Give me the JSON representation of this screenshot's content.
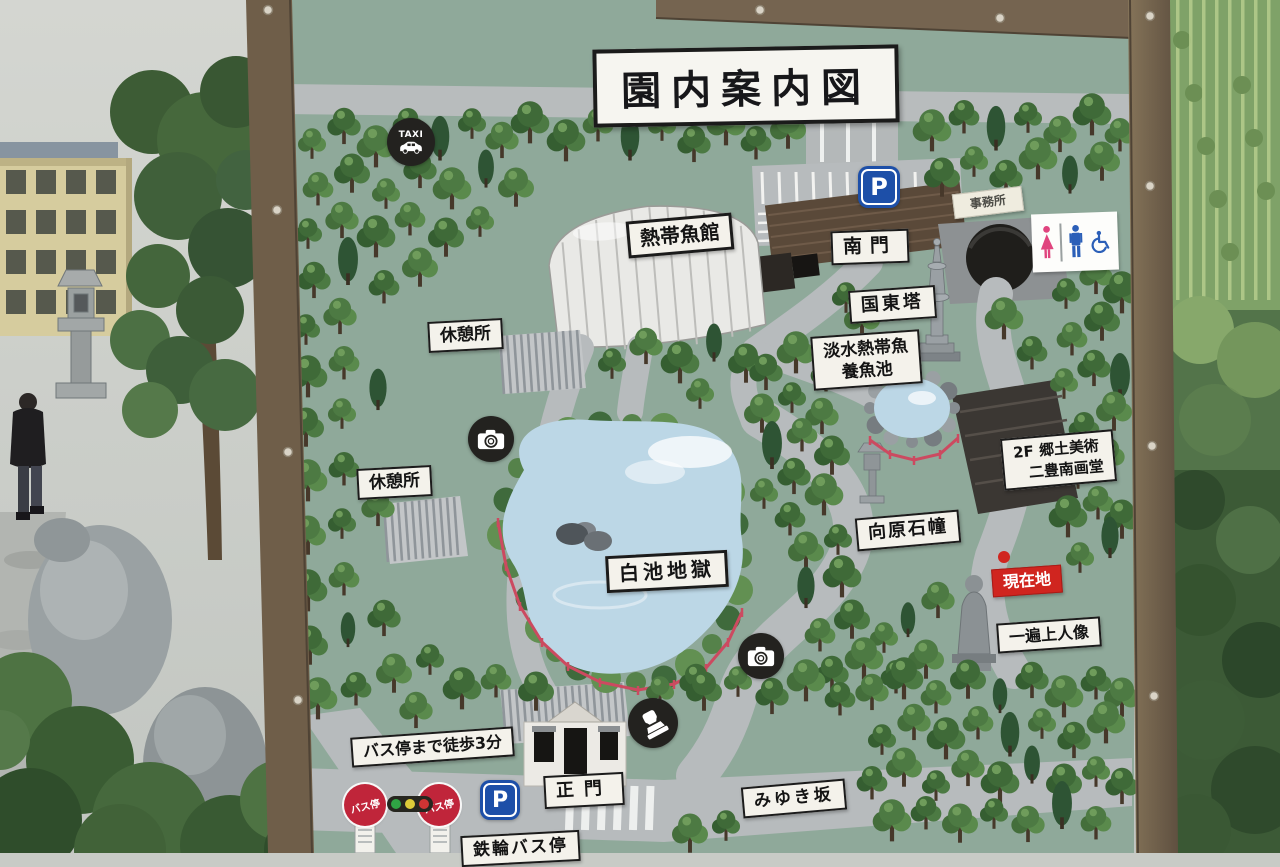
{
  "sign": {
    "title": "園内案内図",
    "labels": {
      "tropical_fish_hall": "熱帯魚館",
      "south_gate": "南門",
      "office": "事務所",
      "kunisaki_tower": "国東塔",
      "freshwater_line1": "淡水熱帯魚",
      "freshwater_line2": "養魚池",
      "rest_area": "休憩所",
      "shiraike_jigoku": "白池地獄",
      "mukaihara_sekido": "向原石幢",
      "gallery_line1": "2F 郷土美術",
      "gallery_line2": "二豊南画堂",
      "current_location": "現在地",
      "ippen_statue": "一遍上人像",
      "bus_walk": "バス停まで徒歩3分",
      "main_gate": "正門",
      "miyuki_slope": "みゆき坂",
      "kannawa_bus_stop": "鉄輪バス停",
      "bus_stop": "バス停",
      "taxi": "TAXI",
      "parking": "P"
    },
    "icons": {
      "taxi": "taxi-icon",
      "parking": "parking-icon",
      "toilet": "toilet-men-women-wheelchair-icon",
      "camera": "photo-spot-icon",
      "stamp": "stamp-spot-icon",
      "traffic_light": "traffic-light-icon",
      "bus_stop": "bus-stop-sign-icon",
      "current_location_dot": "current-location-dot"
    },
    "colors": {
      "board_green": "#8FA99A",
      "path_grey": "#B8BCBD",
      "frame_brown": "#74634E",
      "label_bg": "#F4F2EB",
      "current_red": "#D0251F",
      "bus_red": "#C0253A",
      "parking_blue": "#1D4FA8",
      "pond_blue": "#BCD7E6",
      "tree_green": "#4D7A43",
      "tree_dark_green": "#2E5434",
      "building_brown": "#5A4939",
      "toilet_pink": "#E0447E",
      "toilet_blue": "#2B5FB8",
      "traffic_green": "#2FA344",
      "traffic_yellow": "#DDCB39",
      "traffic_red": "#CE3434"
    }
  }
}
